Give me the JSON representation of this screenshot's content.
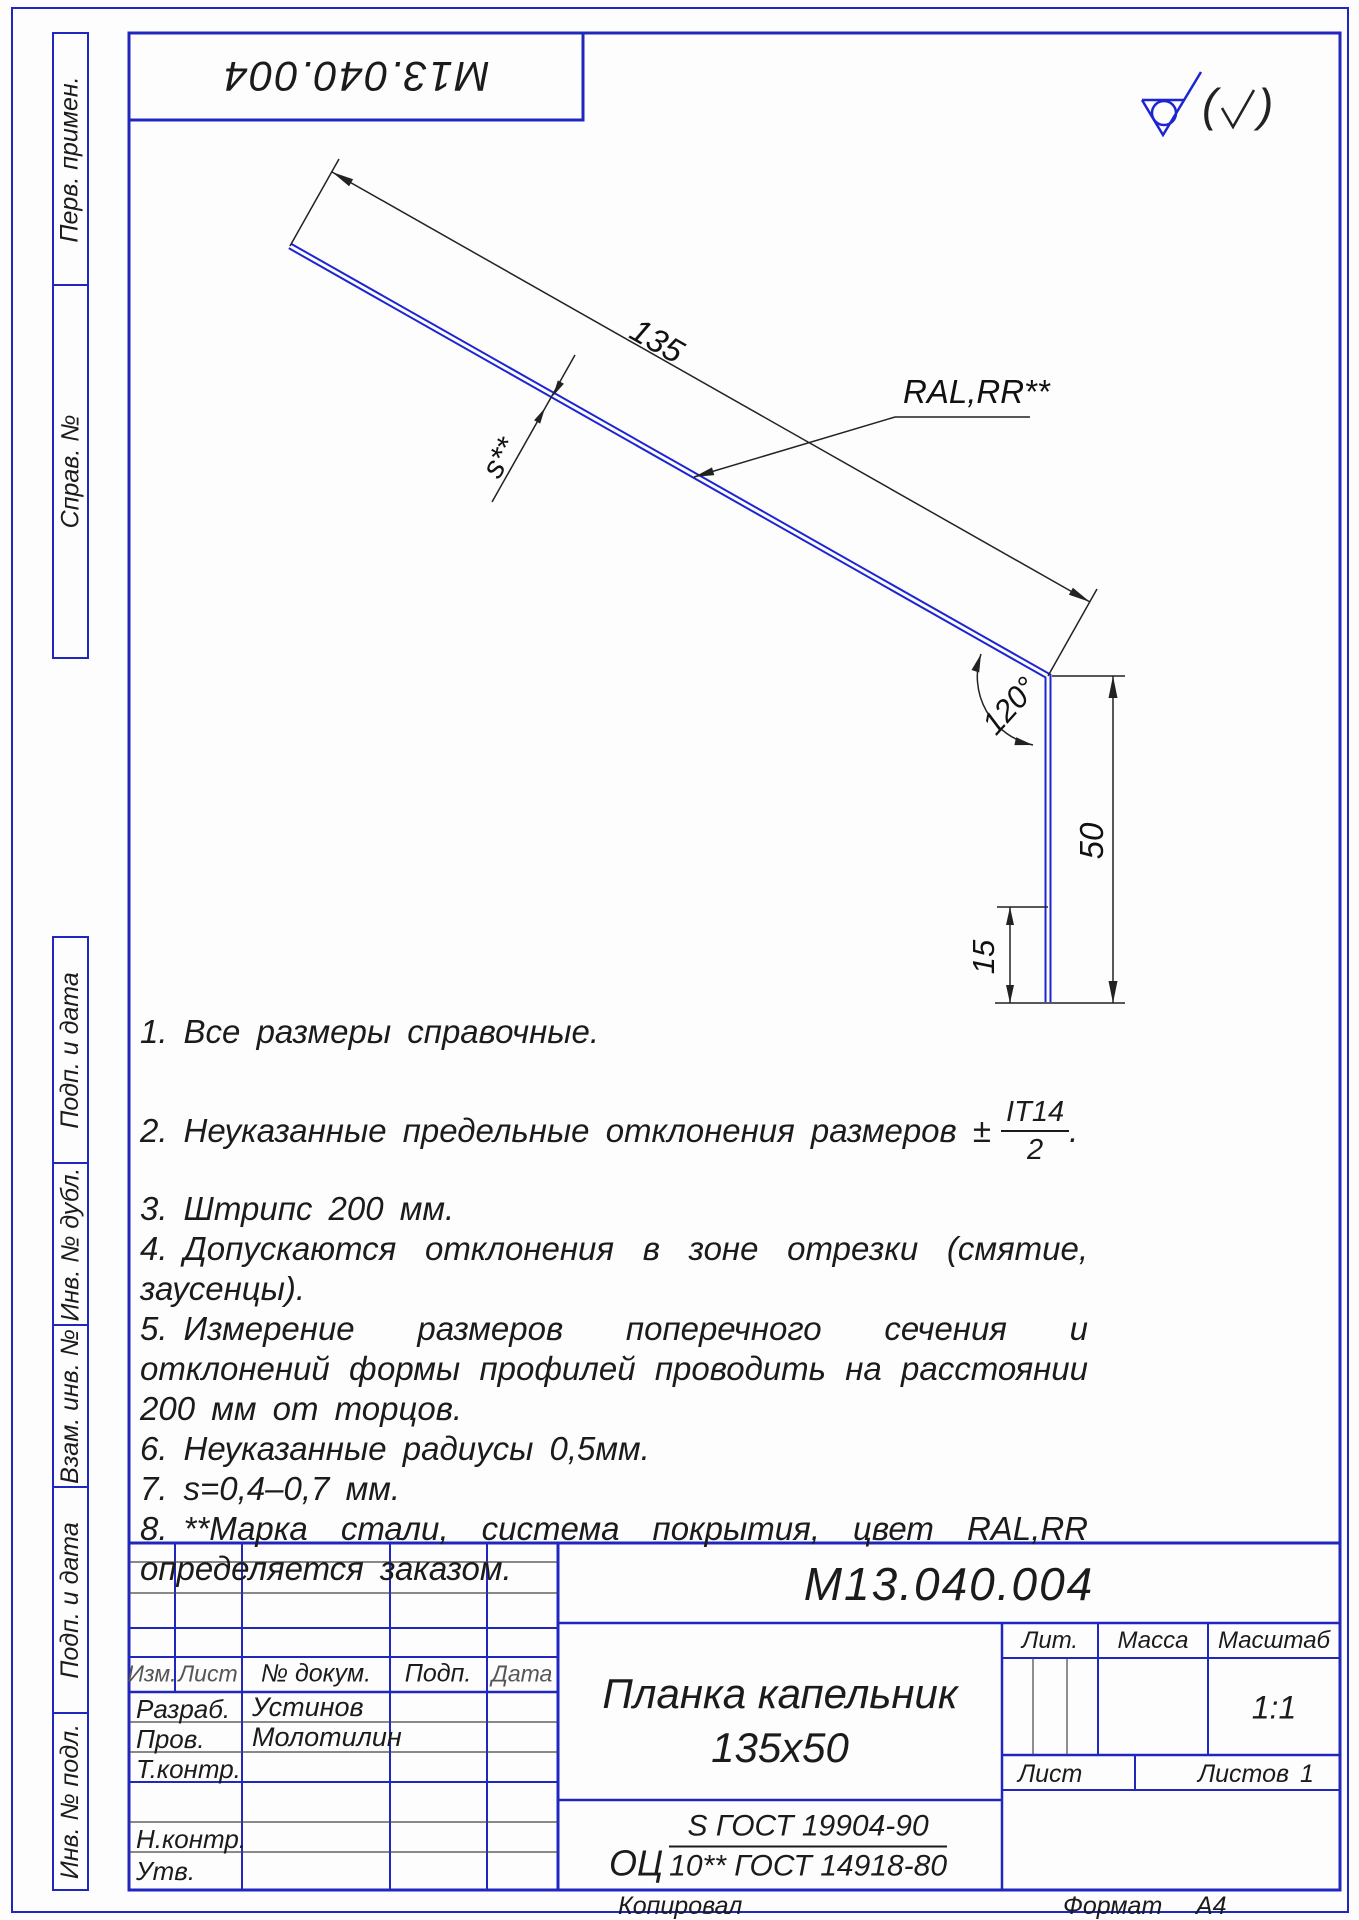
{
  "colors": {
    "frame_blue": "#2127be",
    "profile_blue": "#1d25d2",
    "ink": "#1b1b1b"
  },
  "stamp_top": {
    "code": "М13.040.004"
  },
  "surface_mark": {
    "paren_open": "(",
    "paren_close": ")"
  },
  "sidebar": {
    "labels": [
      "Перв. примен.",
      "Справ. №",
      "Подп. и дата",
      "Инв. № дубл.",
      "Взам. инв. №",
      "Подп. и дата",
      "Инв. № подл."
    ]
  },
  "drawing": {
    "dim_length": "135",
    "dim_thickness": "s**",
    "dim_coating": "RAL,RR**",
    "dim_angle": "120°",
    "dim_height": "50",
    "dim_hem": "15"
  },
  "notes": {
    "n1_num": "1.",
    "n1": "Все размеры справочные.",
    "n2_num": "2.",
    "n2": "Неуказанные предельные отклонения размеров ±",
    "n2_frac_top": "IT14",
    "n2_frac_bot": "2",
    "n2_tail": ".",
    "n3_num": "3.",
    "n3": "Штрипс 200 мм.",
    "n4_num": "4.",
    "n4": "Допускаются отклонения в зоне отрезки (смятие, заусенцы).",
    "n5_num": "5.",
    "n5": "Измерение размеров поперечного сечения и отклонений формы профилей проводить на расстоянии 200 мм от торцов.",
    "n6_num": "6.",
    "n6": "Неуказанные  радиусы 0,5мм.",
    "n7_num": "7.",
    "n7": "s=0,4–0,7 мм.",
    "n8_num": "8.",
    "n8": "**Марка стали, система покрытия, цвет RAL,RR определяется заказом."
  },
  "title_block": {
    "doc_number": "М13.040.004",
    "part_name_line1": "Планка капельник",
    "part_name_line2": "135x50",
    "material_prefix": "ОЦ",
    "material_top": "S ГОСТ 19904-90",
    "material_bottom": "10** ГОСТ 14918-80",
    "col_izm": "Изм.",
    "col_list": "Лист",
    "col_doc": "№ докум.",
    "col_podp": "Подп.",
    "col_data": "Дата",
    "row_razrab": "Разраб.",
    "row_razrab_name": "Устинов",
    "row_prov": "Пров.",
    "row_prov_name": "Молотилин",
    "row_tkontr": "Т.контр.",
    "row_nkontr": "Н.контр.",
    "row_utv": "Утв.",
    "lit_label": "Лит.",
    "massa_label": "Масса",
    "masshtab_label": "Масштаб",
    "scale_value": "1:1",
    "list_label": "Лист",
    "listov_label": "Листов",
    "listov_value": "1"
  },
  "footer": {
    "copied": "Копировал",
    "format_label": "Формат",
    "format_value": "А4"
  }
}
